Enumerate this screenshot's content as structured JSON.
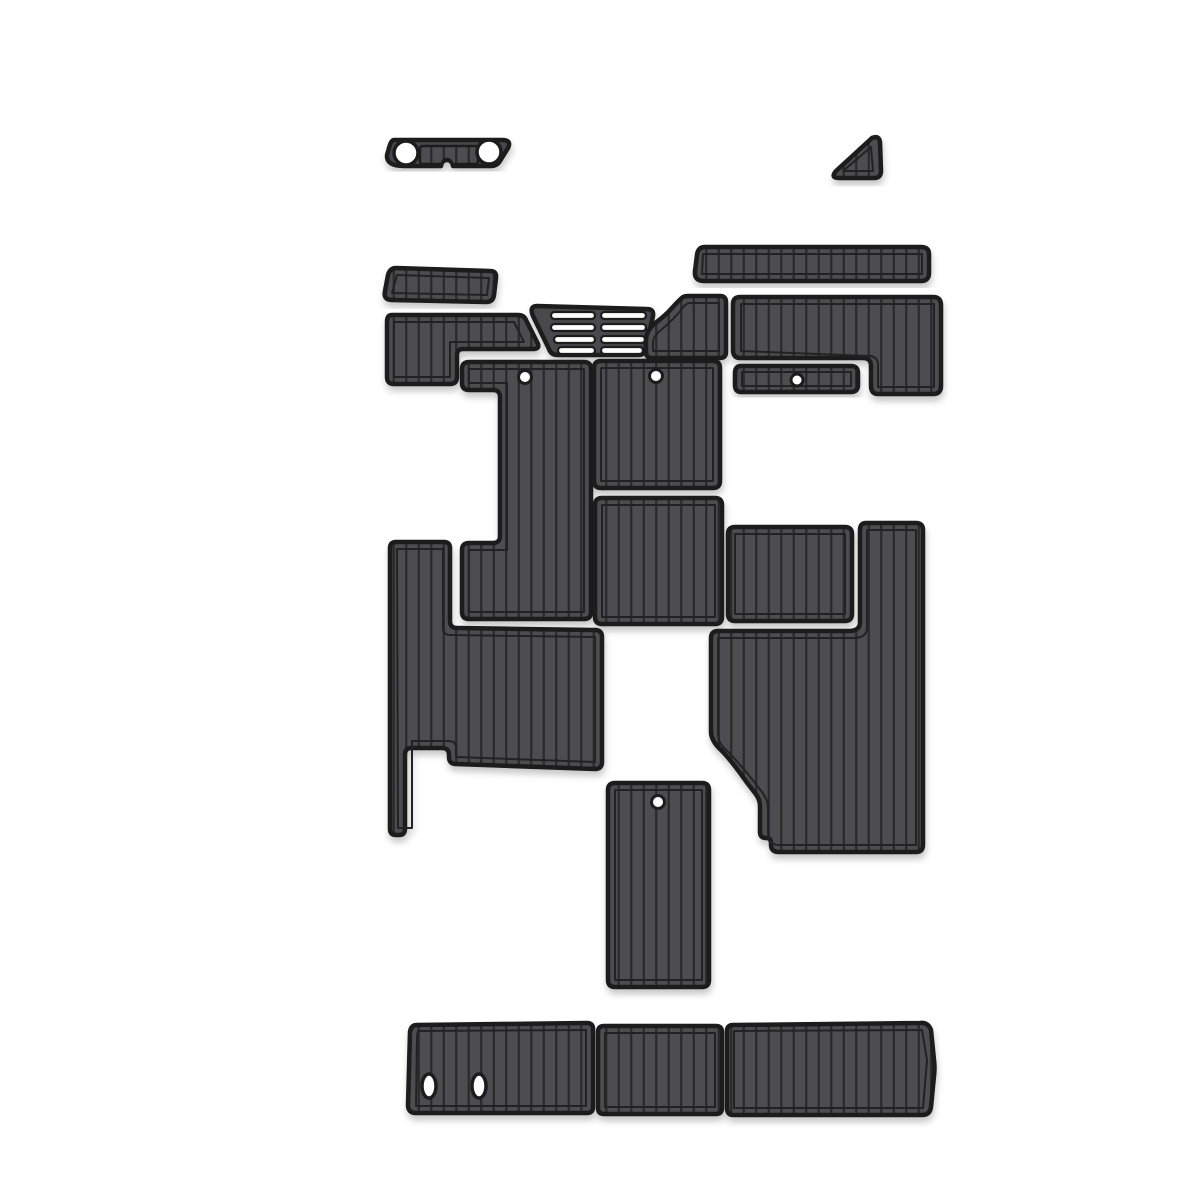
{
  "product": {
    "name": "boat-eva-foam-teak-decking-pad-kit",
    "piece_count": 19,
    "background": "#ffffff"
  },
  "colors": {
    "mat_fill": "#4e4e51",
    "mat_solid": "#4a4a4d",
    "stripe": "#29292b",
    "border": "#1b1b1d",
    "liner_line": "#232325",
    "hole": "#ffffff",
    "shadow": "rgba(0,0,0,0.25)"
  },
  "pieces": [
    {
      "name": "bow-step-pad",
      "d": "M 394,140 L 502,140 Q 512,140 508,148 L 500,161 Q 497,166 491,166 L 453,166 A 6 6 0 0 0 441,166 L 404,166 Q 386,166 387,155 L 389,148 Q 391,140 394,140 Z",
      "belt_d": "M 423,146 L 475,146 Q 478,146 478,149 L 478,161 Q 478,164 475,164 L 452,164 A 5 5 0 0 0 442,164 L 423,164 Q 420,164 420,161 L 420,149 Q 420,146 423,146 Z"
    },
    {
      "name": "corner-triangle-pad",
      "d": "M 872,138 Q 879,135 880,142 L 881,171 Q 881,178 874,178 L 839,178 Q 830,178 836,171 Z",
      "liner": "M 871,147 L 873,171 L 843,171 Z"
    },
    {
      "name": "gunwale-strip-pad",
      "d": "M 705,247 L 921,247 Q 929,247 929,254 L 929,273 Q 929,281 921,281 L 704,281 Q 694,281 695,271 L 697,255 Q 698,247 705,247 Z",
      "liner": "M 703,254 L 922,254 L 922,274 L 702,274 Z"
    },
    {
      "name": "side-step-pad",
      "d": "M 396,268 L 490,271 Q 497,271 496,278 L 494,295 Q 493,302 486,302 L 392,300 Q 383,300 385,291 L 388,275 Q 390,268 396,268 Z",
      "liner": "M 397,275 L 489,278 L 487,295 L 392,293 Z"
    },
    {
      "name": "helm-step-pad",
      "d": "M 392,315 L 518,315 Q 524,315 526,320 L 537,342 Q 541,349 533,349 L 463,349 Q 457,349 457,355 L 457,377 Q 457,384 450,384 L 394,384 Q 387,384 387,377 L 387,322 Q 387,315 392,315 Z",
      "liner": "M 394,322 L 514,322 L 524,342 L 450,342 L 450,377 L 394,377 Z"
    },
    {
      "name": "vent-grate-pad",
      "d": "M 537,306 L 647,309 Q 654,309 653,316 L 646,348 Q 645,355 638,355 L 558,355 Q 551,355 549,349 L 533,316 Q 529,306 537,306 Z"
    },
    {
      "name": "transition-boot-pad",
      "d": "M 688,296 L 720,296 Q 726,296 726,302 L 726,352 Q 726,358 720,358 L 652,358 Q 646,358 646,352 L 646,341 Q 646,331 654,324 Q 665,316 672,308 Q 679,300 683,297 Q 685,296 688,296 Z",
      "liner": "M 689,303 L 719,303 L 719,351 L 653,351 L 653,343 Q 653,336 661,330 Q 673,320 681,310 Q 685,304 689,303 Z"
    },
    {
      "name": "cockpit-side-pad",
      "d": "M 740,297 L 933,297 Q 941,297 941,305 L 941,386 Q 941,394 933,394 L 878,394 Q 871,394 871,386 L 871,366 Q 871,358 863,358 L 740,358 Q 733,358 733,350 L 733,304 Q 733,297 740,297 Z",
      "liner": "M 741,304 L 934,304 L 934,387 L 878,387 L 878,365 Q 878,357 870,356 L 741,351 Z"
    },
    {
      "name": "locker-lid-pad",
      "d": "M 741,366 L 851,366 Q 858,366 858,373 L 858,385 Q 858,392 851,392 L 741,392 Q 735,392 735,385 L 735,373 Q 735,366 741,366 Z",
      "liner": "M 742,372 L 851,372 L 851,386 L 742,386 Z"
    },
    {
      "name": "console-pad",
      "d": "M 469,362 L 584,362 Q 591,362 591,369 L 591,612 Q 591,619 584,619 L 469,619 Q 462,619 462,612 L 462,550 Q 462,543 469,543 L 493,543 Q 500,543 500,536 L 500,397 Q 500,390 493,390 L 469,390 Q 462,390 462,383 L 462,369 Q 462,362 469,362 Z",
      "liner": "M 469,369 L 584,369 L 584,612 L 469,612 L 469,550 L 507,550 L 507,383 L 469,383 Z"
    },
    {
      "name": "seat-base-pad",
      "d": "M 601,361 L 713,361 Q 720,361 720,368 L 720,481 Q 720,488 713,488 L 601,488 Q 594,488 594,481 L 594,368 Q 594,361 601,361 Z",
      "liner": "M 601,368 L 713,368 L 713,481 L 601,481 Z"
    },
    {
      "name": "mid-deck-pad",
      "d": "M 602,498 L 715,498 Q 722,498 722,505 L 722,617 Q 722,624 715,624 L 602,624 Q 595,624 595,617 L 595,505 Q 595,498 602,498 Z",
      "liner": "M 602,505 L 715,505 L 715,617 L 602,617 Z"
    },
    {
      "name": "side-bench-pad",
      "d": "M 735,527 L 845,527 Q 852,527 852,534 L 852,614 Q 852,621 845,621 L 735,621 Q 728,621 728,614 L 728,534 Q 728,527 735,527 Z",
      "liner": "M 735,534 L 845,534 L 845,614 L 735,614 Z"
    },
    {
      "name": "port-deck-pad",
      "d": "M 396,542 L 444,542 Q 450,542 450,548 L 450,621 Q 450,628 457,628 L 595,630 Q 602,630 602,637 L 602,762 Q 602,769 595,769 L 456,764 Q 449,764 449,757 L 449,755 Q 449,748 442,748 L 411,748 Q 405,748 405,755 L 405,829 Q 405,835 399,835 L 396,835 Q 390,835 390,829 L 390,548 Q 390,542 396,542 Z",
      "liner": "M 397,549 L 443,549 L 443,628 Q 443,635 450,635 L 595,637 L 595,762 L 456,757 L 456,748 Q 456,741 449,741 L 412,741 L 412,828 L 398,828 Z"
    },
    {
      "name": "starboard-deck-pad",
      "d": "M 866,523 L 916,523 Q 923,523 923,530 L 923,845 Q 923,852 916,852 L 779,852 Q 771,852 771,845 L 771,843 Q 771,838 766,838 Q 760,838 760,832 L 760,806 Q 760,799 755,793 Q 747,783 740,773 Q 729,758 722,751 Q 711,741 711,732 L 711,638 Q 711,631 718,631 L 849,631 Q 860,631 860,622 L 860,530 Q 860,523 866,523 Z",
      "liner": "M 867,530 L 916,530 L 916,845 L 779,845 Q 768,845 768,832 L 768,808 Q 768,800 762,792 Q 750,776 741,766 Q 730,753 724,748 Q 718,742 718,733 L 718,638 L 853,638 Q 867,638 867,628 Z"
    },
    {
      "name": "engine-hatch-pad",
      "d": "M 615,783 L 702,783 Q 709,783 709,790 L 709,980 Q 709,987 702,987 L 615,987 Q 608,987 608,980 L 608,790 Q 608,783 615,783 Z",
      "liner": "M 615,790 L 702,790 L 702,980 L 615,980 Z"
    },
    {
      "name": "swim-platform-left-pad",
      "d": "M 417,1025 L 587,1023 Q 593,1023 593,1029 L 593,1107 Q 593,1113 587,1113 L 416,1113 Q 408,1113 408,1105 L 410,1032 Q 411,1025 417,1025 Z",
      "liner": "M 418,1031 L 586,1030 L 586,1106 L 416,1106 L 417,1036 Z"
    },
    {
      "name": "swim-platform-center-pad",
      "d": "M 604,1026 L 716,1026 Q 722,1026 722,1032 L 722,1108 Q 722,1114 716,1114 L 604,1114 Q 598,1114 598,1108 L 598,1032 Q 598,1026 604,1026 Z",
      "liner": "M 605,1033 L 715,1033 L 715,1107 L 605,1107 Z"
    },
    {
      "name": "swim-platform-right-pad",
      "d": "M 733,1025 L 920,1023 Q 928,1022 931,1030 L 934,1060 Q 935,1068 934,1076 L 931,1107 Q 930,1115 922,1115 L 733,1115 Q 727,1115 727,1108 L 727,1031 Q 727,1025 733,1025 Z",
      "liner": "M 734,1031 L 922,1030 L 927,1060 L 923,1108 L 734,1108 Z"
    }
  ],
  "screw_holes": [
    {
      "cx": 525,
      "cy": 377,
      "r": 6.5
    },
    {
      "cx": 656,
      "cy": 376,
      "r": 6.5
    },
    {
      "cx": 797,
      "cy": 380,
      "r": 6
    },
    {
      "cx": 658,
      "cy": 802,
      "r": 6.5
    }
  ],
  "bow_holes": [
    {
      "cx": 406,
      "cy": 153,
      "r": 12
    },
    {
      "cx": 489,
      "cy": 152,
      "r": 12
    }
  ],
  "oval_holes": [
    {
      "cx": 429,
      "cy": 1086,
      "rx": 7,
      "ry": 12
    },
    {
      "cx": 479,
      "cy": 1086,
      "rx": 7,
      "ry": 12
    }
  ],
  "grate_slots": [
    {
      "x": 551,
      "y": 312,
      "w": 44,
      "h": 7
    },
    {
      "x": 551,
      "y": 324,
      "w": 44,
      "h": 7
    },
    {
      "x": 554,
      "y": 336,
      "w": 41,
      "h": 7
    },
    {
      "x": 558,
      "y": 347,
      "w": 37,
      "h": 7
    },
    {
      "x": 601,
      "y": 312,
      "w": 45,
      "h": 7
    },
    {
      "x": 601,
      "y": 324,
      "w": 45,
      "h": 7
    },
    {
      "x": 601,
      "y": 336,
      "w": 44,
      "h": 7
    },
    {
      "x": 601,
      "y": 347,
      "w": 42,
      "h": 7
    }
  ]
}
